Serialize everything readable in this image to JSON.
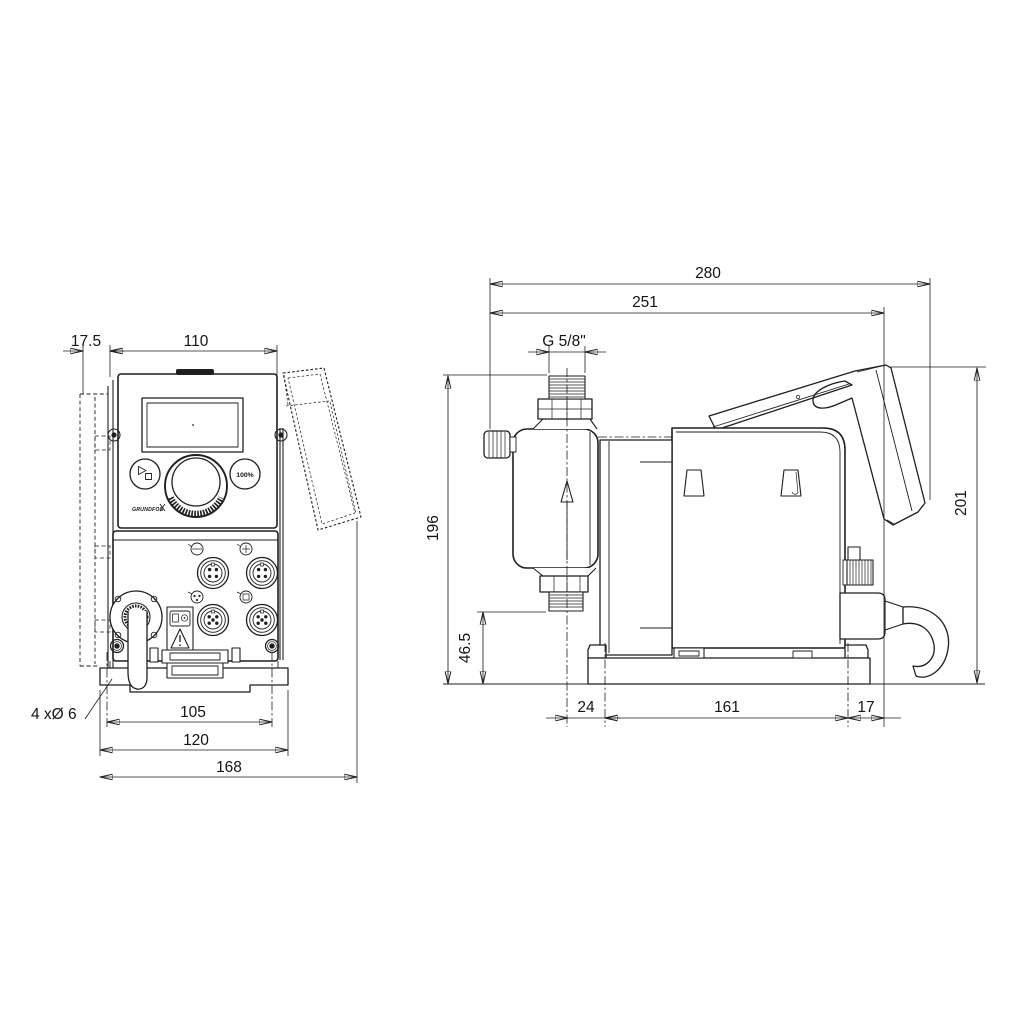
{
  "front_view": {
    "dims": {
      "wall_offset": "17.5",
      "housing_width": "110",
      "hole_spacing": "105",
      "plate_width": "120",
      "overall_width": "168"
    },
    "holes_note": "4 xØ 6",
    "control_panel": {
      "percent_button": "100%",
      "logo": "GRUNDFOS"
    }
  },
  "side_view": {
    "dims": {
      "overall_depth": "280",
      "depth_to_back": "251",
      "connection_thread": "G 5/8\"",
      "height_to_connection": "196",
      "suction_height": "46.5",
      "overall_height": "201",
      "base_front_offset": "24",
      "base_hole_spacing": "161",
      "base_rear_offset": "17"
    }
  },
  "icons": {
    "start_stop": "play-stop",
    "flow_direction": "up-arrow",
    "warning": "triangle-exclamation"
  }
}
